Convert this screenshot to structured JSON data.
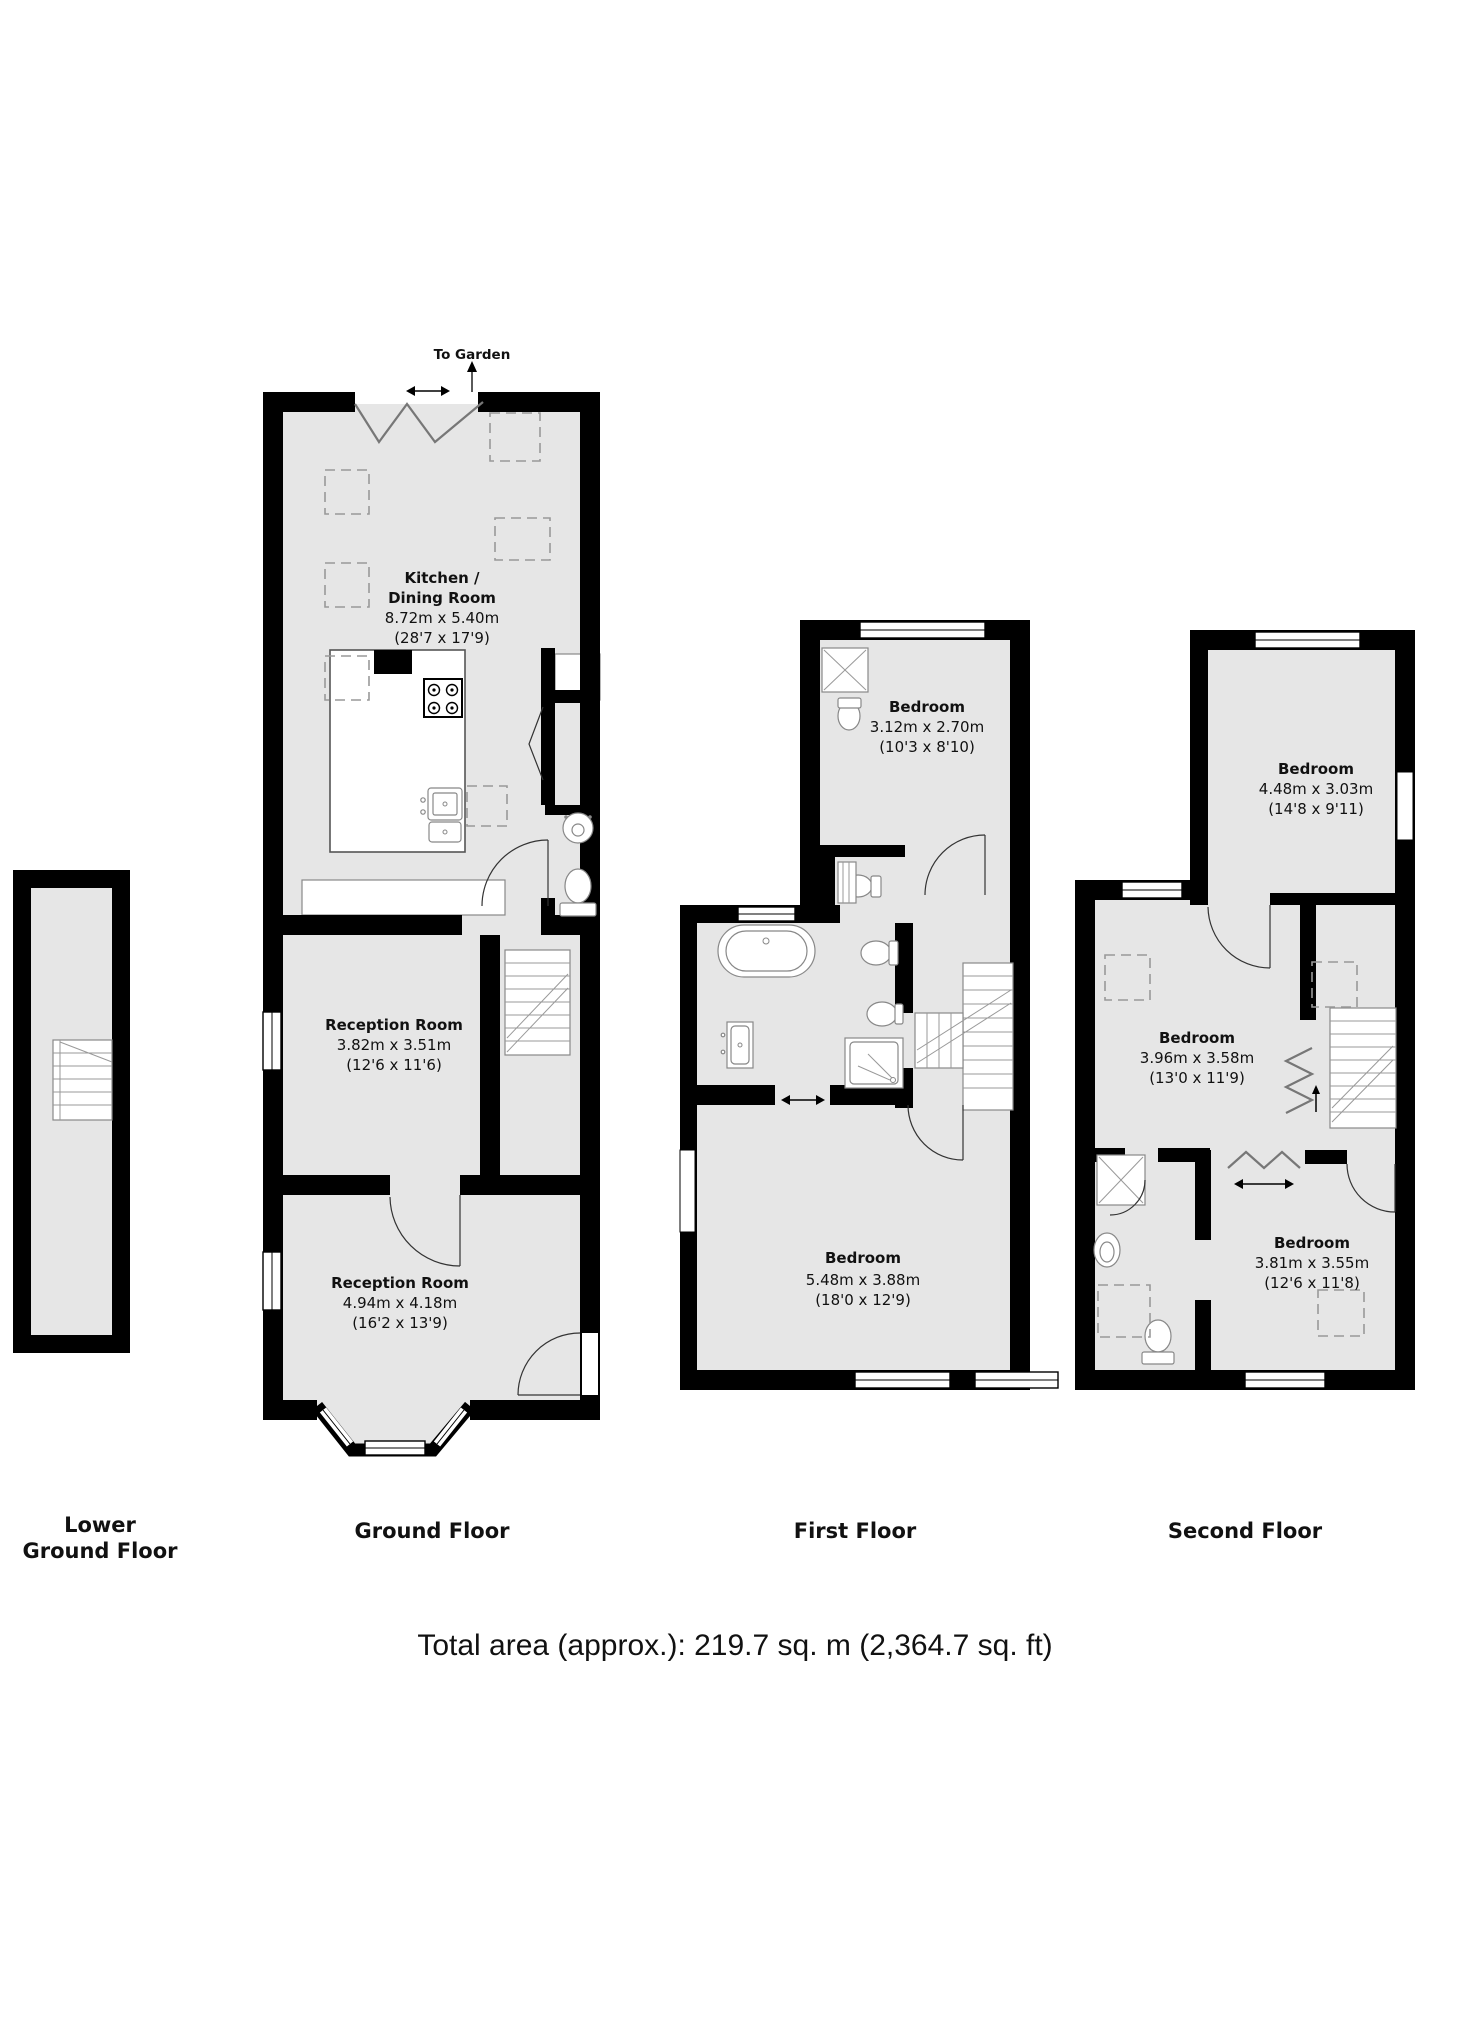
{
  "colors": {
    "wall": "#000000",
    "room_fill": "#e6e6e6",
    "background": "#ffffff",
    "fixture_stroke": "#888888"
  },
  "floors": {
    "lower_ground": {
      "label_line1": "Lower",
      "label_line2": "Ground Floor"
    },
    "ground": {
      "label": "Ground Floor",
      "to_garden": "To Garden",
      "rooms": {
        "kitchen": {
          "name_line1": "Kitchen /",
          "name_line2": "Dining Room",
          "dims_metric": "8.72m x 5.40m",
          "dims_imperial": "(28'7 x 17'9)"
        },
        "reception1": {
          "name": "Reception Room",
          "dims_metric": "3.82m x 3.51m",
          "dims_imperial": "(12'6 x 11'6)"
        },
        "reception2": {
          "name": "Reception Room",
          "dims_metric": "4.94m x 4.18m",
          "dims_imperial": "(16'2 x 13'9)"
        }
      }
    },
    "first": {
      "label": "First Floor",
      "rooms": {
        "bedroom_small": {
          "name": "Bedroom",
          "dims_metric": "3.12m x 2.70m",
          "dims_imperial": "(10'3 x 8'10)"
        },
        "bedroom_main": {
          "name": "Bedroom",
          "dims_metric": "5.48m x 3.88m",
          "dims_imperial": "(18'0 x 12'9)"
        }
      }
    },
    "second": {
      "label": "Second Floor",
      "rooms": {
        "bedroom_top": {
          "name": "Bedroom",
          "dims_metric": "4.48m x 3.03m",
          "dims_imperial": "(14'8 x 9'11)"
        },
        "bedroom_middle": {
          "name": "Bedroom",
          "dims_metric": "3.96m x 3.58m",
          "dims_imperial": "(13'0 x 11'9)"
        },
        "bedroom_bottom": {
          "name": "Bedroom",
          "dims_metric": "3.81m x 3.55m",
          "dims_imperial": "(12'6 x 11'8)"
        }
      }
    }
  },
  "footer": {
    "total_area": "Total area (approx.): 219.7 sq. m (2,364.7 sq. ft)"
  }
}
